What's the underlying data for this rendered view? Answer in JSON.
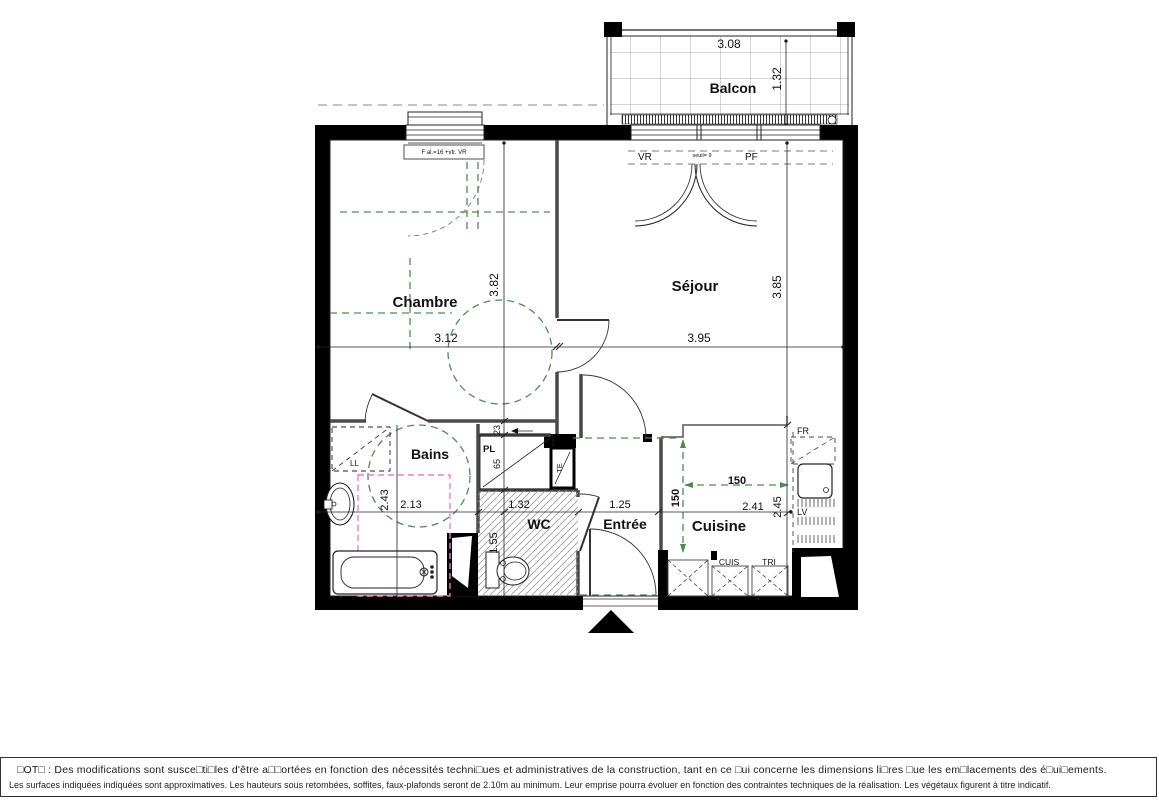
{
  "plan": {
    "rooms": {
      "balcon": "Balcon",
      "chambre": "Chambre",
      "sejour": "Séjour",
      "bains": "Bains",
      "wc": "WC",
      "entree": "Entrée",
      "cuisine": "Cuisine"
    },
    "dims": {
      "balcon_w": "3.08",
      "balcon_d": "1.32",
      "chambre_w": "3.12",
      "chambre_h": "3.82",
      "sejour_w": "3.95",
      "sejour_h": "3.85",
      "bains_w": "2.13",
      "bains_h": "2.43",
      "recess": "23",
      "closet": "65",
      "wc_w": "1.32",
      "wc_h": "1.55",
      "entree_w": "1.25",
      "cuisine_w": "2.41",
      "cuisine_h": "2.45",
      "clear_v": "150",
      "clear_h": "150"
    },
    "annot": {
      "window_spec": "F al.=16 +vtr. VR",
      "vr": "VR",
      "pf": "PF",
      "seuil": "seuil= 9",
      "ll": "LL",
      "pl": "PL",
      "te": "TE",
      "fr": "FR",
      "lv": "LV",
      "cuis": "CUIS",
      "tri": "TRI"
    },
    "colors": {
      "accessibility_green": "#4e8a52",
      "clearance_pink": "#ee7fc3",
      "wall_black": "#000000"
    }
  },
  "notes": {
    "line1": "□OT□ :  Des modifications sont susce□ti□les d'être a□□ortées en fonction des nécessités techni□ues et administratives de la construction, tant en ce □ui concerne les dimensions li□res □ue les em□lacements des é□ui□ements.",
    "line2": "Les surfaces indiquées indiquées sont approximatives. Les hauteurs sous retombées, soffites, faux-plafonds seront de 2.10m au minimum. Leur emprise pourra évoluer en fonction des contraintes techniques de la réalisation. Les végétaux figurent à titre indicatif."
  }
}
